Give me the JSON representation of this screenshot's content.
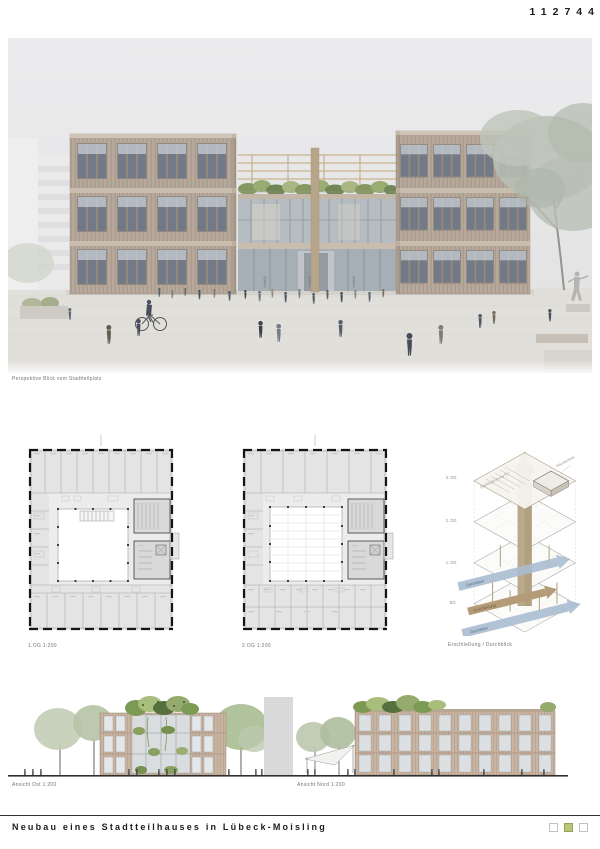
{
  "header": {
    "project_number": "112744"
  },
  "perspective": {
    "caption": "Perspektive Blick vom Stadtteilplatz"
  },
  "plans": [
    {
      "label": "1.OG 1:200"
    },
    {
      "label": "2.OG 1:200"
    }
  ],
  "axonometric": {
    "caption": "Erschließung / Durchblick",
    "levels": [
      "3. OG",
      "2. OG",
      "1. OG",
      "EG"
    ],
    "annotations": {
      "roof_left": "Dachbegrünung PV",
      "roof_right": "Haustechnik",
      "flow_main": "Erschließung",
      "flow_view": "Durchblick"
    }
  },
  "elevations": [
    {
      "label": "Ansicht Ost 1:200"
    },
    {
      "label": "Ansicht Nord 1:200"
    }
  ],
  "footer": {
    "title": "Neubau eines Stadtteilhauses in Lübeck-Moisling",
    "legend": {
      "squares": [
        "empty",
        "filled",
        "empty"
      ],
      "active_color": "#b8c878"
    }
  },
  "palette": {
    "timber_facade": "#b2a394",
    "green_roof": "#7e9258",
    "arrow_blue": "#aabdd0",
    "arrow_tan": "#b49c79"
  }
}
